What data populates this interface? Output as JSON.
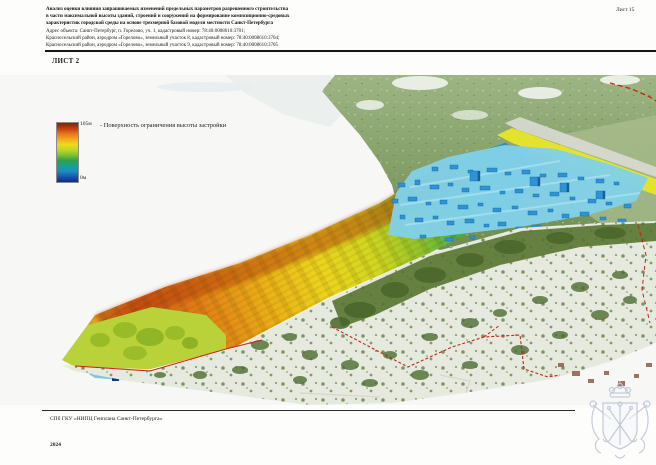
{
  "document": {
    "sheet_number": "Лист 15",
    "title_lines": [
      "Анализ оценки влияния запрашиваемых изменений предельных параметров разрешенного строительства",
      "в части максимальной высоты зданий, строений и сооружений на формирование композиционно-средовых",
      "характеристик городской среды на основе трехмерной базовой модели местности Санкт-Петербурга"
    ],
    "address_lines": [
      "Адрес объекта: Санкт-Петербург, п. Горелово, уч. 1, кадастровый номер: 78:40:0008610:3701;",
      "Красносельский район, аэродром «Горелово», земельный участок 8, кадастровый номер: 78:40:0008610:3704;",
      "Красносельский район, аэродром «Горелово», земельный участок 9, кадастровый номер: 78:40:0008610:3705"
    ],
    "sheet_label": "ЛИСТ 2"
  },
  "legend": {
    "max_label": "105м",
    "min_label": "0м",
    "description": "- Поверхность ограничения высоты застройки",
    "gradient_colors_top_to_bottom": [
      "#7d2606",
      "#c23b10",
      "#e8741c",
      "#f2a81c",
      "#f0d820",
      "#c2d626",
      "#7cc030",
      "#2f9f48",
      "#19a08f",
      "#1b8ec0",
      "#1a56ae",
      "#0d2d7c"
    ]
  },
  "map": {
    "colors": {
      "boundary_red": "#c42414",
      "building_blue": "#2e93d5",
      "plateau_cyan": "#82d0e8",
      "runway_yellow": "#e3e32e",
      "terrain_green": "#7d9a5e",
      "surface_high": "#d35d12",
      "surface_low": "#2e78b8"
    }
  },
  "footer": {
    "organization": "СПб ГКУ «НИПЦ Генплана Санкт-Петербурга»",
    "year": "2024"
  },
  "emblem": {
    "name": "Герб Санкт-Петербурга",
    "color": "#c2c8d6"
  }
}
